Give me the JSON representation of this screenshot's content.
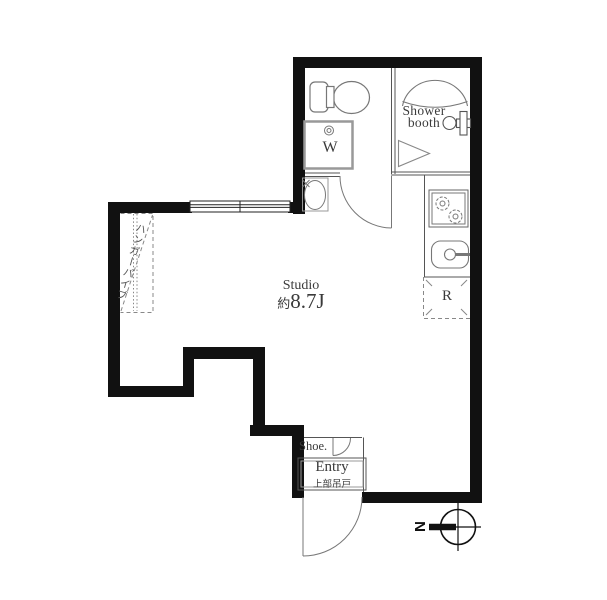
{
  "plan": {
    "room": {
      "label": "Studio",
      "area_prefix": "約",
      "area_value": "8.7J"
    },
    "shower": {
      "line1": "Shower",
      "line2": "booth"
    },
    "appliances": {
      "washer": "W",
      "refrigerator": "R"
    },
    "entry": {
      "label": "Entry",
      "note": "上部吊戸",
      "shoe": "Shoe."
    },
    "closet": {
      "hanger_pipe": "ハンガーパイプ"
    },
    "compass": {
      "north": "N"
    },
    "colors": {
      "wall": "#111111",
      "thin_line": "#555555",
      "fixture_line": "#777777",
      "text": "#3a3a3a",
      "background": "#ffffff"
    }
  }
}
